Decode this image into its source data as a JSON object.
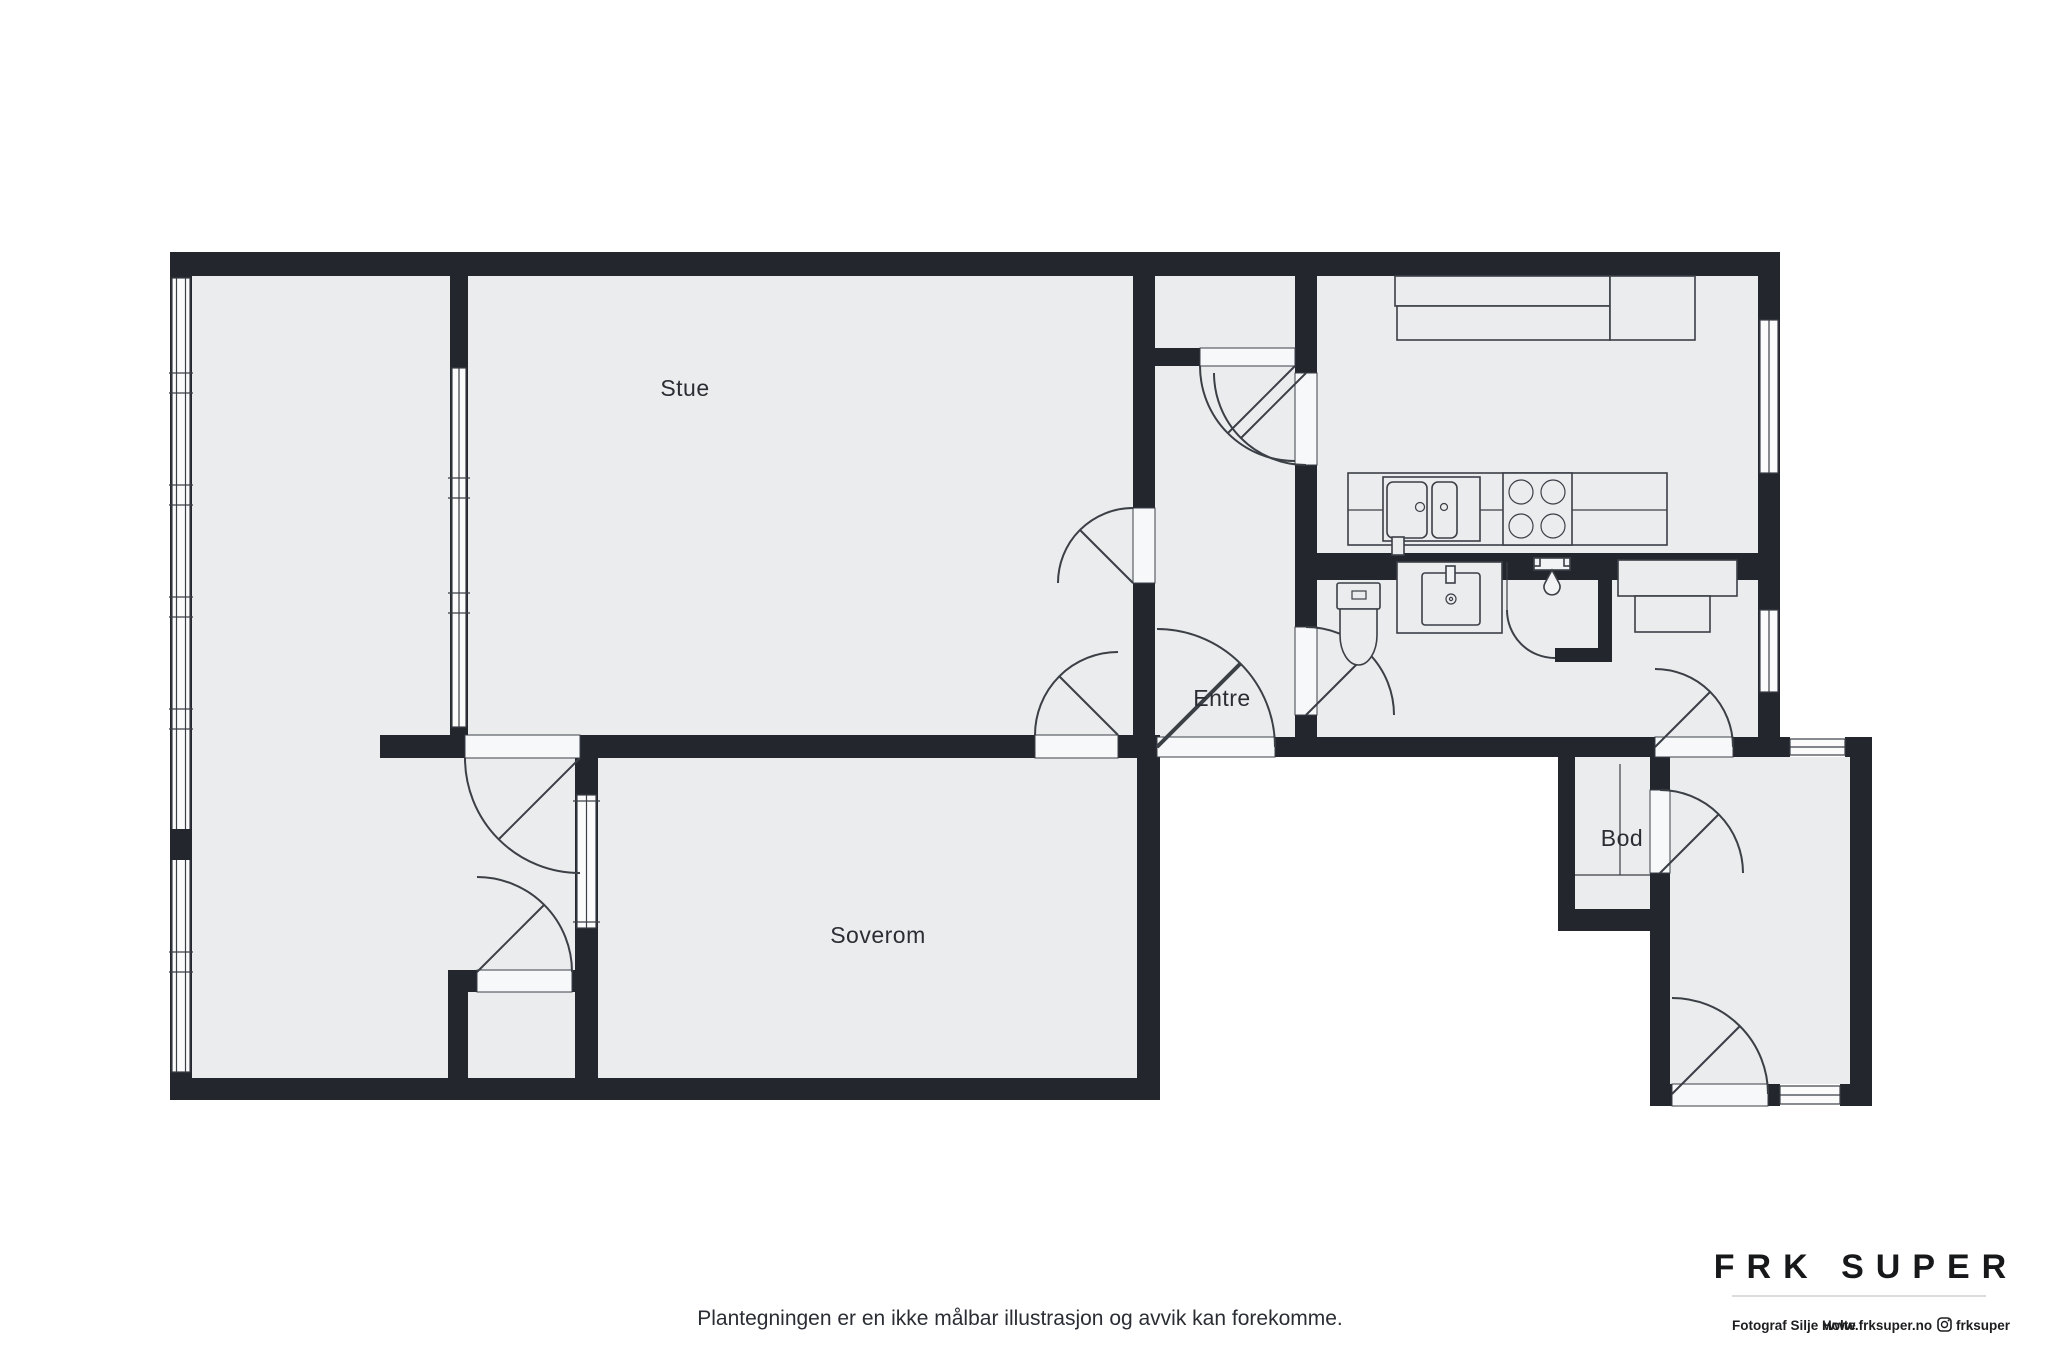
{
  "page": {
    "background": "#ffffff"
  },
  "floorplan": {
    "rooms": [
      {
        "id": "stue",
        "label": "Stue"
      },
      {
        "id": "soverom",
        "label": "Soverom"
      },
      {
        "id": "entre",
        "label": "Entre"
      },
      {
        "id": "bod",
        "label": "Bod"
      }
    ],
    "fixtures": [
      "kitchen-cabinets-icon",
      "kitchen-sink-icon",
      "stove-burners-icon",
      "toilet-icon",
      "vanity-sink-icon",
      "shower-icon",
      "shower-head-icon",
      "laundry-bench-icon",
      "storage-shelf-icon",
      "window-icon",
      "door-swing-icon"
    ],
    "colors": {
      "wall": "#23262d",
      "floor": "#ebecee",
      "line": "#3b3f46",
      "window": "#fbfbfc"
    }
  },
  "footer": {
    "disclaimer": "Plantegningen er en ikke målbar illustrasjon og avvik kan forekomme."
  },
  "branding": {
    "logo": "FRK SUPER",
    "credits": {
      "photographer": "Fotograf Silje Holte",
      "website": "www.frksuper.no",
      "instagram": "frksuper",
      "instagram_icon": "instagram-icon"
    }
  }
}
